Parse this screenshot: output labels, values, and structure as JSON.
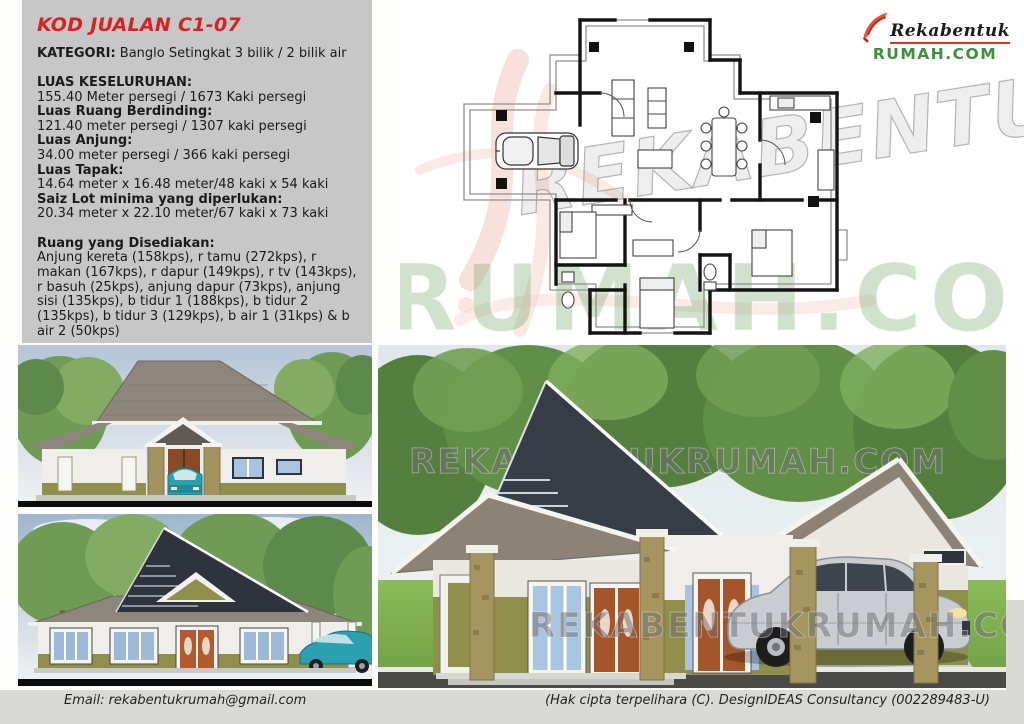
{
  "info_panel": {
    "code": "KOD JUALAN C1-07",
    "category_label": "KATEGORI:",
    "category_value": " Banglo Setingkat 3 bilik / 2 bilik air",
    "specs": [
      {
        "label": "LUAS KESELURUHAN:",
        "value": "155.40 Meter persegi / 1673 Kaki persegi"
      },
      {
        "label": "Luas Ruang Berdinding:",
        "value": "121.40 meter persegi / 1307 kaki persegi"
      },
      {
        "label": "Luas Anjung:",
        "value": "34.00 meter persegi / 366 kaki persegi"
      },
      {
        "label": "Luas Tapak:",
        "value": "14.64 meter x 16.48 meter/48 kaki x 54 kaki"
      },
      {
        "label": "Saiz Lot minima yang diperlukan:",
        "value": "20.34 meter x 22.10 meter/67 kaki x 73 kaki"
      }
    ],
    "rooms_label": "Ruang yang Disediakan:",
    "rooms_text": "Anjung kereta (158kps), r tamu (272kps), r makan (167kps), r dapur (149kps), r tv (143kps), r basuh (25kps), anjung dapur (73kps), anjung sisi (135kps), b tidur 1 (188kps), b tidur 2 (135kps), b tidur 3 (129kps), b air 1 (31kps) & b air 2 (50kps)"
  },
  "logo": {
    "brand_top": "Rekabentuk",
    "brand_bottom": "RUMAH.COM",
    "accent_color": "#e2542f",
    "green_color": "#3f8f3f"
  },
  "watermarks": {
    "plan_script": "REKABENTUK",
    "plan_domain": "RUMAH.COM",
    "render_text": "REKABENTUKRUMAH.COM"
  },
  "footer": {
    "email": "Email: rekabentukrumah@gmail.com",
    "copyright": "(Hak cipta terpelihara (C). DesignIDEAS Consultancy (002289483-U)"
  },
  "colors": {
    "panel_bg": "#c7c7c7",
    "title_red": "#d92121",
    "roof_gray": "#8d8276",
    "roof_dark": "#343b44",
    "wall_olive": "#8f8f4b",
    "glass_blue": "#a8c4e0",
    "footer_bg": "#d9d9d5"
  }
}
